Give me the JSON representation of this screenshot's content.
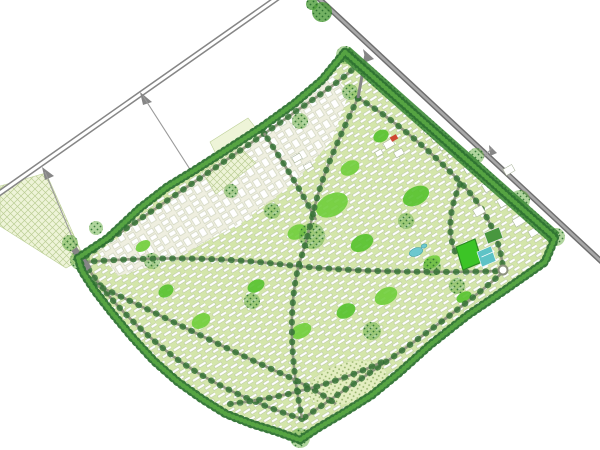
{
  "meta": {
    "label": "Master plan site map of a residential community bounded by two diagonal highways",
    "canvas": {
      "w": 600,
      "h": 450
    }
  },
  "palette": {
    "background": "#ffffff",
    "highway_gray": "#868686",
    "highway_dark": "#6f6f6f",
    "highway_center": "#a8a8a8",
    "thin_road": "#9a9a9a",
    "road_casing": "#8d937d",
    "road_tree": "#2f6f31",
    "site_base": "#d4e6ab",
    "row_white": "#ffffff",
    "row_edge": "#98a87f",
    "court_base": "#efefe0",
    "court_edge": "#b4bd9e",
    "field_pale": "#eef4d8",
    "field_pale2": "#e3eec0",
    "hatch_line": "#bccf96",
    "park_green": "#6fce3a",
    "park_green2": "#55c22c",
    "tree_dark": "#2e7231",
    "tree_mid": "#4f9e3b",
    "tree_light": "#5aa844",
    "forest_band": "#3f8c38",
    "cluster_fill": "#6fb24c",
    "stipple_olive": "#6d9440",
    "building_white": "#ffffff",
    "building_edge": "#a3af93",
    "red_roof": "#cf4732",
    "sports_green": "#3cc426",
    "sports_edge": "#2b8a22",
    "court_teal": "#5ec3c6",
    "pool_teal": "#6cc8cf",
    "pool_edge": "#3a9aa0",
    "green_roof": "#48973f"
  },
  "map": {
    "outside_fields": [
      {
        "name": "west-farm-field",
        "points": [
          [
            0,
            186
          ],
          [
            46,
            173
          ],
          [
            84,
            258
          ],
          [
            66,
            268
          ],
          [
            0,
            226
          ]
        ]
      }
    ],
    "highways": [
      {
        "name": "highway-west",
        "pts": [
          [
            -6,
            197
          ],
          [
            283,
            -6
          ]
        ],
        "casing_w": 6,
        "center_w": 3,
        "casing": "#868686",
        "center": "#ffffff"
      },
      {
        "name": "highway-northeast",
        "pts": [
          [
            314,
            -6
          ],
          [
            603,
            263
          ]
        ],
        "casing_w": 5.5,
        "center_w": 2.6,
        "casing": "#6f6f6f",
        "center": "#a8a8a8"
      }
    ],
    "gores": [
      {
        "name": "ramp-gore-1",
        "points": [
          [
            140,
            92
          ],
          [
            152,
            102
          ],
          [
            143,
            105
          ]
        ]
      },
      {
        "name": "ramp-gore-2",
        "points": [
          [
            42,
            167
          ],
          [
            54,
            176
          ],
          [
            45,
            180
          ]
        ]
      },
      {
        "name": "ramp-gore-3",
        "points": [
          [
            363,
            49
          ],
          [
            374,
            59
          ],
          [
            366,
            62
          ]
        ]
      },
      {
        "name": "ramp-gore-4",
        "points": [
          [
            489,
            145
          ],
          [
            497,
            153
          ],
          [
            490,
            156
          ]
        ]
      }
    ],
    "access_roads": [
      {
        "name": "access-road-to-fields",
        "pts": [
          [
            143,
            96
          ],
          [
            193,
            174
          ]
        ]
      },
      {
        "name": "access-road-to-entrance",
        "pts": [
          [
            45,
            172
          ],
          [
            80,
            256
          ]
        ]
      },
      {
        "name": "spur-northeast",
        "pts": [
          [
            492,
            148
          ],
          [
            483,
            158
          ]
        ]
      }
    ],
    "entrance_stub": {
      "name": "west-entrance-pavement",
      "pts": [
        [
          74,
          249
        ],
        [
          89,
          269
        ]
      ],
      "w": 6.5
    },
    "ne_entrance": {
      "name": "northeast-entrance-road",
      "pts": [
        [
          366,
          54
        ],
        [
          358,
          98
        ]
      ],
      "w": 3
    },
    "site": {
      "boundary": [
        [
          345,
          52
        ],
        [
          555,
          238
        ],
        [
          545,
          262
        ],
        [
          505,
          290
        ],
        [
          468,
          315
        ],
        [
          430,
          345
        ],
        [
          400,
          372
        ],
        [
          372,
          395
        ],
        [
          345,
          412
        ],
        [
          318,
          428
        ],
        [
          300,
          440
        ],
        [
          278,
          432
        ],
        [
          252,
          424
        ],
        [
          226,
          414
        ],
        [
          202,
          399
        ],
        [
          178,
          382
        ],
        [
          154,
          361
        ],
        [
          132,
          337
        ],
        [
          112,
          313
        ],
        [
          95,
          291
        ],
        [
          82,
          271
        ],
        [
          78,
          258
        ],
        [
          108,
          238
        ],
        [
          140,
          208
        ],
        [
          167,
          187
        ],
        [
          195,
          170
        ],
        [
          228,
          149
        ],
        [
          262,
          127
        ],
        [
          295,
          103
        ],
        [
          322,
          80
        ]
      ],
      "forest_band": {
        "pts": [
          [
            345,
            52
          ],
          [
            555,
            238
          ]
        ],
        "w": 14
      }
    },
    "northwest_district": {
      "name": "courtyard-housing-district",
      "points": [
        [
          98,
          252
        ],
        [
          165,
          204
        ],
        [
          232,
          150
        ],
        [
          292,
          106
        ],
        [
          330,
          75
        ],
        [
          350,
          90
        ],
        [
          332,
          140
        ],
        [
          295,
          182
        ],
        [
          243,
          222
        ],
        [
          172,
          260
        ],
        [
          118,
          276
        ]
      ]
    },
    "orchard_fields": [
      {
        "name": "orchard-field-plain",
        "points": [
          [
            210,
            142
          ],
          [
            248,
            118
          ],
          [
            262,
            136
          ],
          [
            222,
            166
          ]
        ],
        "hatch": false
      },
      {
        "name": "orchard-field-hatched",
        "points": [
          [
            202,
            172
          ],
          [
            240,
            147
          ],
          [
            256,
            163
          ],
          [
            216,
            194
          ]
        ],
        "hatch": true
      }
    ],
    "south_park": {
      "name": "south-meadow-park",
      "cx": 347,
      "cy": 383,
      "rx": 40,
      "ry": 20,
      "rot": -17
    },
    "parks": [
      [
        332,
        205,
        17,
        11,
        -28
      ],
      [
        362,
        243,
        12,
        8,
        -28
      ],
      [
        297,
        232,
        10,
        7,
        -28
      ],
      [
        416,
        196,
        14,
        9,
        -28
      ],
      [
        386,
        296,
        12,
        8,
        -28
      ],
      [
        346,
        311,
        10,
        7,
        -28
      ],
      [
        301,
        331,
        11,
        7,
        -28
      ],
      [
        256,
        286,
        9,
        6,
        -28
      ],
      [
        201,
        321,
        10,
        7,
        -32
      ],
      [
        166,
        291,
        8,
        6,
        -32
      ],
      [
        143,
        246,
        8,
        5,
        -32
      ],
      [
        464,
        297,
        8,
        5,
        -28
      ],
      [
        350,
        168,
        10,
        7,
        -28
      ],
      [
        381,
        136,
        8,
        6,
        -28
      ],
      [
        432,
        262,
        9,
        6,
        -28
      ]
    ],
    "tree_clusters": [
      [
        312,
        236,
        13
      ],
      [
        272,
        211,
        8
      ],
      [
        300,
        121,
        8
      ],
      [
        231,
        191,
        7
      ],
      [
        432,
        267,
        9
      ],
      [
        457,
        286,
        8
      ],
      [
        152,
        261,
        8
      ],
      [
        372,
        331,
        9
      ],
      [
        252,
        301,
        8
      ],
      [
        406,
        221,
        8
      ],
      [
        476,
        156,
        8
      ],
      [
        520,
        200,
        10
      ],
      [
        350,
        92,
        8
      ],
      [
        345,
        55,
        9
      ],
      [
        300,
        438,
        10
      ],
      [
        80,
        260,
        10
      ],
      [
        556,
        237,
        9
      ],
      [
        70,
        243,
        8
      ],
      [
        96,
        228,
        7
      ]
    ],
    "outer_groves": [
      [
        322,
        12,
        10
      ],
      [
        312,
        4,
        6
      ]
    ],
    "roads": [
      {
        "name": "road-nw-perimeter",
        "d": "M86,256 C150,212 235,155 295,112 C315,98 335,85 352,70"
      },
      {
        "name": "road-ne-perimeter",
        "d": "M358,98 C395,120 435,155 463,185 C488,212 500,240 503,268"
      },
      {
        "name": "road-se-perimeter",
        "d": "M503,272 C472,300 428,332 393,357 C358,381 328,401 304,418"
      },
      {
        "name": "road-sw-perimeter",
        "d": "M302,419 C255,404 208,382 174,357 C138,329 106,297 84,262"
      },
      {
        "name": "road-central-spine",
        "d": "M84,262 C150,257 215,257 278,264 C345,272 430,273 502,271"
      },
      {
        "name": "road-north-south",
        "d": "M358,98 C338,140 320,180 313,214 C306,244 302,255 299,264 C290,300 288,350 302,418"
      },
      {
        "name": "road-nw-diagonal",
        "d": "M262,130 C283,162 302,192 316,220"
      },
      {
        "name": "road-south-loop",
        "d": "M94,284 C155,312 220,346 278,372 C305,384 322,394 336,404"
      },
      {
        "name": "road-south-park",
        "d": "M230,404 C280,398 330,386 382,362"
      },
      {
        "name": "road-east-district",
        "d": "M460,184 C449,210 447,234 456,254"
      }
    ],
    "roundabout": {
      "cx": 503,
      "cy": 270,
      "r": 4.5
    },
    "buildings": [
      [
        389,
        144,
        10,
        7
      ],
      [
        399,
        153,
        9,
        6
      ],
      [
        379,
        153,
        7,
        5
      ],
      [
        430,
        130,
        13,
        4
      ],
      [
        438,
        138,
        13,
        4
      ],
      [
        446,
        146,
        13,
        4
      ],
      [
        454,
        154,
        13,
        4
      ],
      [
        489,
        186,
        12,
        9
      ],
      [
        504,
        201,
        12,
        9
      ],
      [
        479,
        211,
        10,
        8
      ],
      [
        519,
        221,
        11,
        8
      ],
      [
        509,
        170,
        10,
        7
      ],
      [
        469,
        169,
        9,
        7
      ],
      [
        534,
        232,
        10,
        7
      ],
      [
        297,
        158,
        9,
        6
      ],
      [
        308,
        166,
        8,
        5
      ]
    ],
    "red_building": {
      "name": "red-roof-landmark",
      "cx": 394,
      "cy": 138,
      "w": 7,
      "h": 5,
      "rot": -30
    },
    "sports_field": {
      "name": "sports-field",
      "points": [
        [
          456,
          247
        ],
        [
          475,
          239
        ],
        [
          482,
          262
        ],
        [
          463,
          270
        ]
      ]
    },
    "tennis_courts": {
      "name": "tennis-courts",
      "points": [
        [
          477,
          252
        ],
        [
          491,
          246
        ],
        [
          496,
          261
        ],
        [
          482,
          267
        ]
      ]
    },
    "green_roof_building": {
      "name": "green-roof-building",
      "points": [
        [
          484,
          233
        ],
        [
          499,
          227
        ],
        [
          503,
          238
        ],
        [
          488,
          244
        ]
      ]
    },
    "pools": [
      {
        "name": "swimming-pool-large",
        "cx": 416,
        "cy": 252,
        "rx": 7,
        "ry": 4,
        "rot": -20
      },
      {
        "name": "swimming-pool-small",
        "cx": 424,
        "cy": 246,
        "rx": 3,
        "ry": 2,
        "rot": -20
      }
    ]
  }
}
